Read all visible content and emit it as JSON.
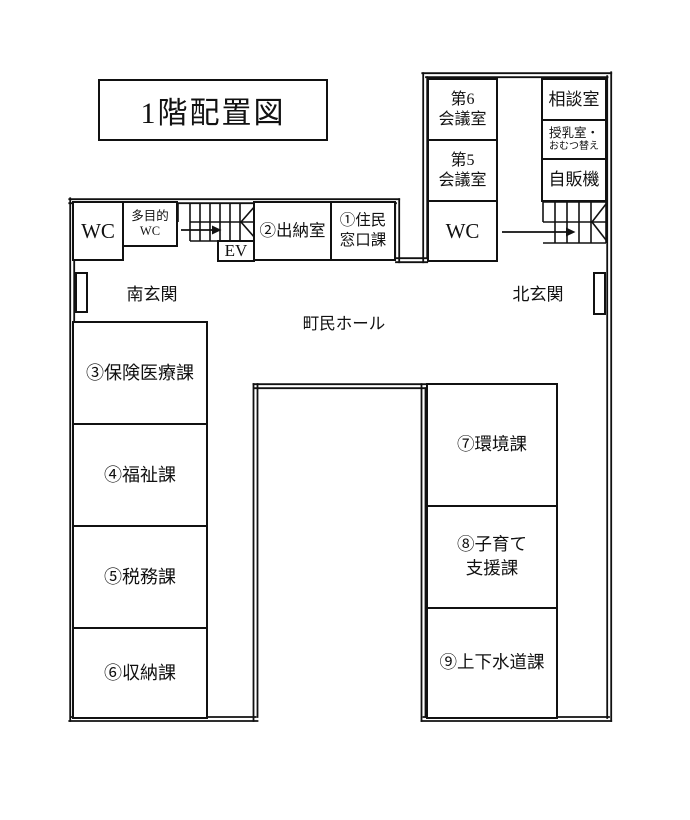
{
  "title": "1階配置図",
  "colors": {
    "line": "#111111",
    "bg": "#ffffff"
  },
  "floor": {
    "halls": {
      "main_hall": "町民ホール",
      "south_entrance": "南玄関",
      "north_entrance": "北玄関"
    },
    "west_wing": {
      "wc": "WC",
      "multipurpose_wc": "多目的\nWC",
      "elevator": "EV",
      "cashier": "②出納室",
      "resident_counter": "①住民\n窓口課"
    },
    "north_wing": {
      "meeting_room_6": "第6\n会議室",
      "meeting_room_5": "第5\n会議室",
      "wc": "WC",
      "consultation": "相談室",
      "nursing_line1": "授乳室・",
      "nursing_line2": "おむつ替え",
      "vending": "自販機"
    },
    "west_rooms": [
      {
        "label": "③保険医療課"
      },
      {
        "label": "④福祉課"
      },
      {
        "label": "⑤税務課"
      },
      {
        "label": "⑥収納課"
      }
    ],
    "east_rooms": [
      {
        "label": "⑦環境課"
      },
      {
        "label": "⑧子育て\n支援課"
      },
      {
        "label": "⑨上下水道課"
      }
    ]
  }
}
